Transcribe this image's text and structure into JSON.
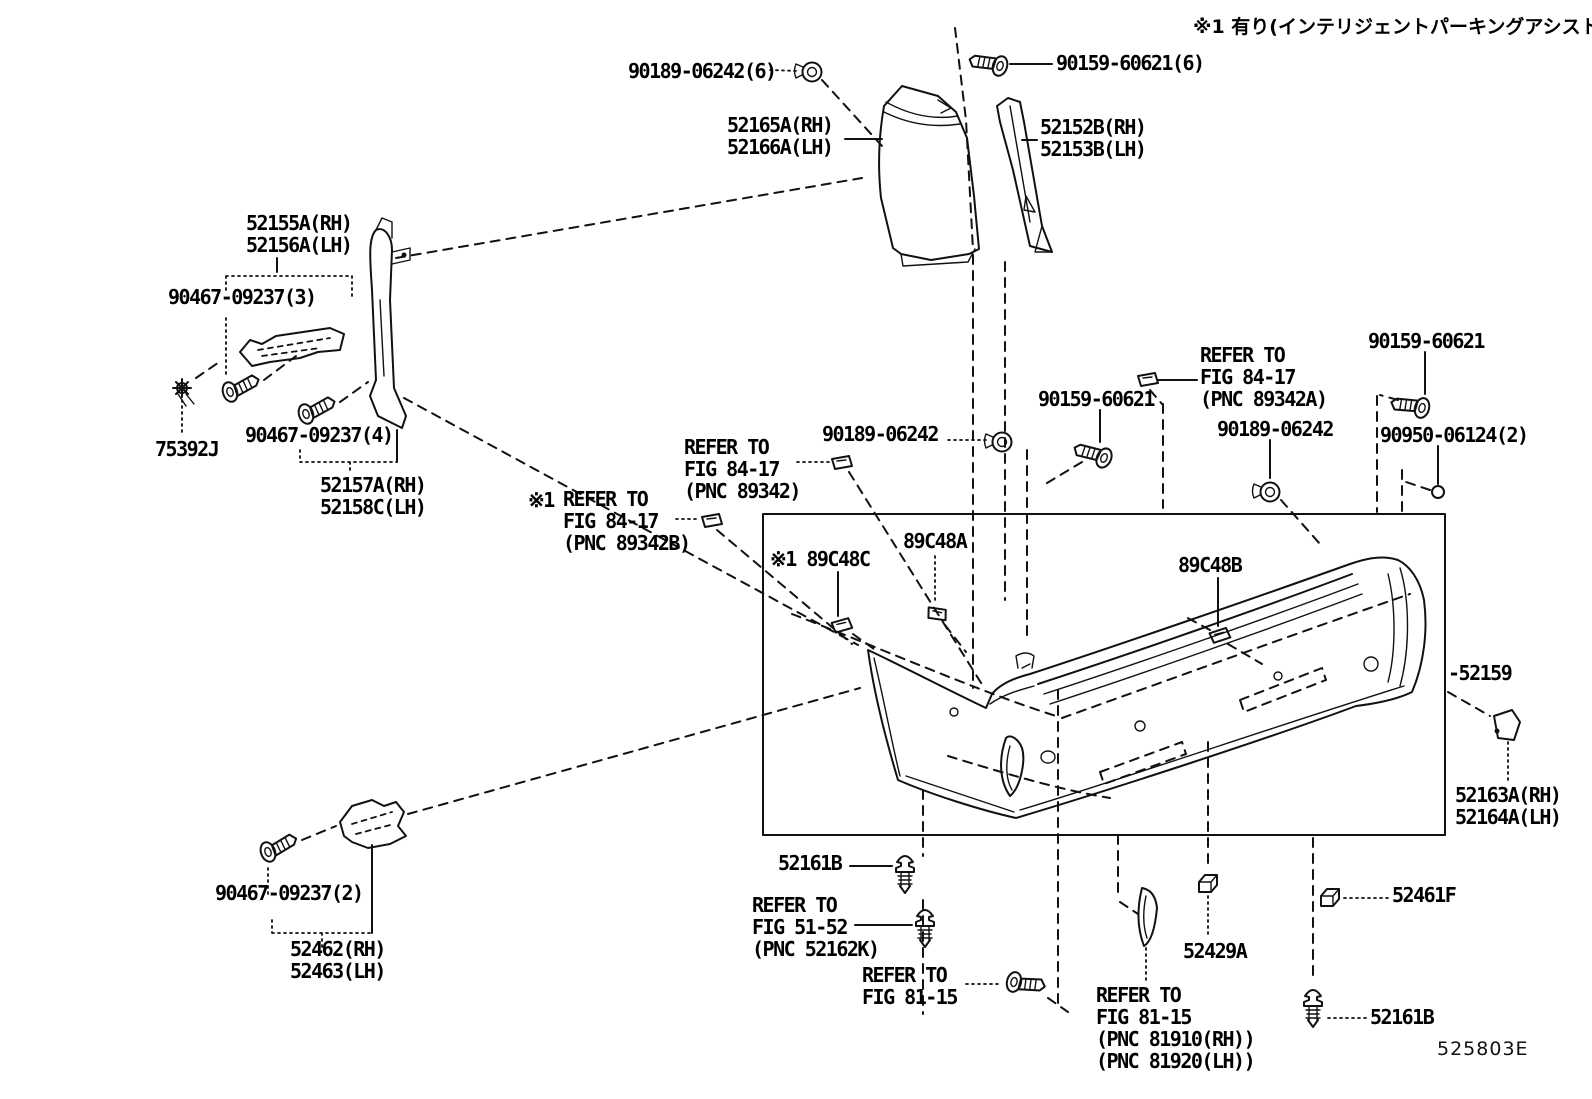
{
  "diagram": {
    "description": "Toyota parts catalog line-art diagram: rear bumper and mouldings",
    "note_top_right": "※1 有り(インテリジェントパーキングアシスト)",
    "drawing_code": "525803E",
    "labels": [
      {
        "name": "note-intelligent-parking-assist",
        "text": "※1 有り(インテリジェントパーキングアシスト)",
        "x": 1193,
        "y": 16,
        "cls": "jp"
      },
      {
        "name": "part-label-90189-06242-6",
        "text": "90189-06242(6)",
        "x": 628,
        "y": 60
      },
      {
        "name": "part-label-90159-60621-6",
        "text": "90159-60621(6)",
        "x": 1056,
        "y": 52
      },
      {
        "name": "part-label-52165a-52166a",
        "text": "52165A(RH)\n52166A(LH)",
        "x": 727,
        "y": 114
      },
      {
        "name": "part-label-52152b-52153b",
        "text": "52152B(RH)\n52153B(LH)",
        "x": 1040,
        "y": 116
      },
      {
        "name": "part-label-52155a-52156a",
        "text": "52155A(RH)\n52156A(LH)",
        "x": 246,
        "y": 212
      },
      {
        "name": "part-label-90467-09237-3",
        "text": "90467-09237(3)",
        "x": 168,
        "y": 286
      },
      {
        "name": "part-label-75392j",
        "text": "75392J",
        "x": 155,
        "y": 438
      },
      {
        "name": "part-label-90467-09237-4",
        "text": "90467-09237(4)",
        "x": 245,
        "y": 424
      },
      {
        "name": "part-label-52157a-52158c",
        "text": "52157A(RH)\n52158C(LH)",
        "x": 320,
        "y": 474
      },
      {
        "name": "refer-note-pnc-89342",
        "text": "REFER TO\nFIG 84-17\n(PNC 89342)",
        "x": 684,
        "y": 436
      },
      {
        "name": "note-mark-1",
        "text": "※1",
        "x": 528,
        "y": 489
      },
      {
        "name": "refer-note-pnc-89342b",
        "text": "REFER TO\nFIG 84-17\n(PNC 89342B)",
        "x": 563,
        "y": 488
      },
      {
        "name": "part-label-90189-06242-center",
        "text": "90189-06242",
        "x": 822,
        "y": 423
      },
      {
        "name": "part-label-90159-60621-center",
        "text": "90159-60621",
        "x": 1038,
        "y": 388
      },
      {
        "name": "refer-note-pnc-89342a",
        "text": "REFER TO\nFIG 84-17\n(PNC 89342A)",
        "x": 1200,
        "y": 344
      },
      {
        "name": "part-label-90159-60621-right",
        "text": "90159-60621",
        "x": 1368,
        "y": 330
      },
      {
        "name": "part-label-90189-06242-right",
        "text": "90189-06242",
        "x": 1217,
        "y": 418
      },
      {
        "name": "part-label-90950-06124-2",
        "text": "90950-06124(2)",
        "x": 1380,
        "y": 424
      },
      {
        "name": "part-label-89c48c",
        "text": "※1 89C48C",
        "x": 770,
        "y": 548
      },
      {
        "name": "part-label-89c48a",
        "text": "89C48A",
        "x": 903,
        "y": 530
      },
      {
        "name": "part-label-89c48b",
        "text": "89C48B",
        "x": 1178,
        "y": 554
      },
      {
        "name": "part-label-52159",
        "text": "-52159",
        "x": 1448,
        "y": 662
      },
      {
        "name": "part-label-52163a-52164a",
        "text": "52163A(RH)\n52164A(LH)",
        "x": 1455,
        "y": 784
      },
      {
        "name": "part-label-52161b-left",
        "text": "52161B",
        "x": 778,
        "y": 852
      },
      {
        "name": "refer-note-pnc-52162k",
        "text": "REFER TO\nFIG 51-52\n(PNC 52162K)",
        "x": 752,
        "y": 894
      },
      {
        "name": "refer-note-fig-81-15-left",
        "text": "REFER TO\nFIG 81-15",
        "x": 862,
        "y": 964
      },
      {
        "name": "refer-note-fig-81-15-right",
        "text": "REFER TO\nFIG 81-15\n(PNC 81910(RH))\n(PNC 81920(LH))",
        "x": 1096,
        "y": 984
      },
      {
        "name": "part-label-52429a",
        "text": "52429A",
        "x": 1183,
        "y": 940
      },
      {
        "name": "part-label-52461f",
        "text": "52461F",
        "x": 1392,
        "y": 884
      },
      {
        "name": "part-label-52161b-right",
        "text": "52161B",
        "x": 1370,
        "y": 1006
      },
      {
        "name": "part-label-90467-09237-2",
        "text": "90467-09237(2)",
        "x": 215,
        "y": 882
      },
      {
        "name": "part-label-52462-52463",
        "text": "52462(RH)\n52463(LH)",
        "x": 290,
        "y": 938
      },
      {
        "name": "drawing-code",
        "text": "525803E",
        "x": 1437,
        "y": 1038,
        "cls": "code"
      }
    ]
  }
}
